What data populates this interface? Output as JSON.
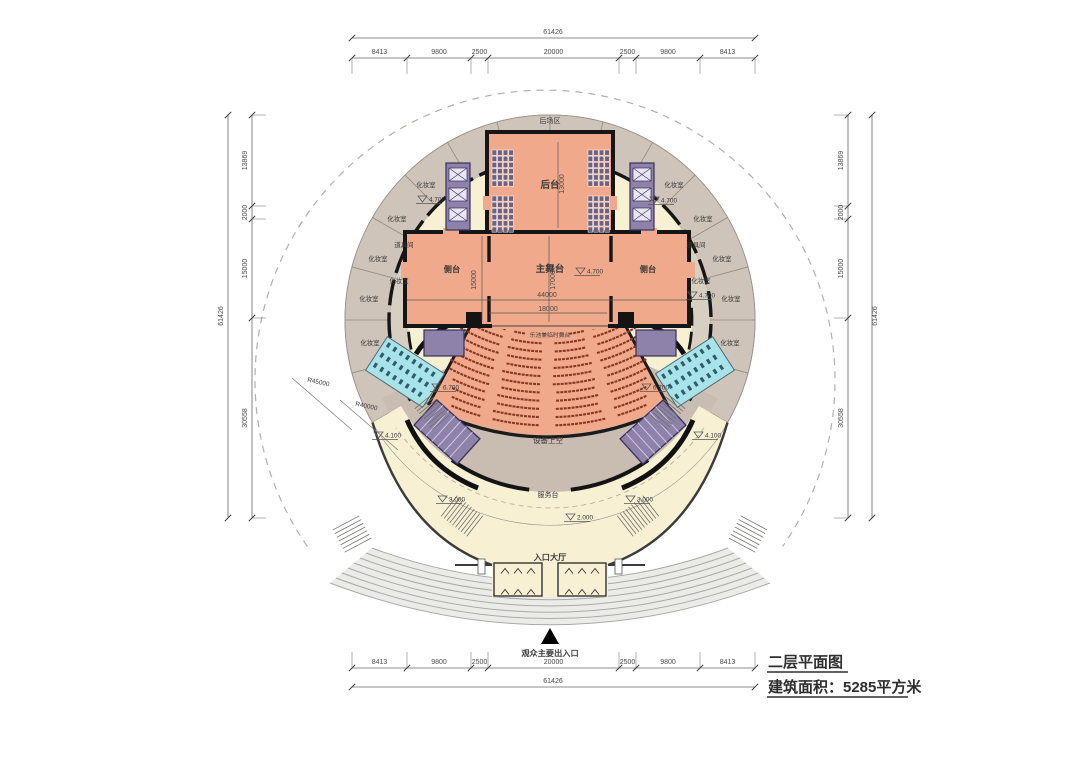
{
  "title_block": {
    "plan_title": "二层平面图",
    "area_label": "建筑面积：5285平方米"
  },
  "dims": {
    "total": "61426",
    "h_segments": [
      "8413",
      "9800",
      "2500",
      "20000",
      "2500",
      "9800",
      "8413"
    ],
    "v_segments": [
      "13869",
      "2000",
      "15000",
      "30558"
    ]
  },
  "stage_dims": {
    "d13000": "13000",
    "d15000": "15000",
    "d17000": "17000",
    "d44000": "44000",
    "d18000": "18000"
  },
  "elevations": {
    "e47": "4.700",
    "e67": "6.700",
    "e41": "4.100",
    "e30": "3.000",
    "e20": "2.000"
  },
  "radii": {
    "r45": "R45000",
    "r40": "R40000"
  },
  "rooms": {
    "backstage_zone": "后场区",
    "rear_stage": "后台",
    "main_stage": "主舞台",
    "side_stage": "侧台",
    "dressing_room": "化妆室",
    "props_room": "道具间",
    "orchestra_pit": "乐池兼临时舞台",
    "equipment_void": "设备上空",
    "service_desk": "服务台",
    "entrance_hall": "入口大厅",
    "main_entrance": "观众主要出入口"
  },
  "colors": {
    "stage_salmon": "#f0a98b",
    "ring_taupe": "#cfc4b9",
    "walkway_taupe": "#c9bcb1",
    "cream": "#f7f0d3",
    "stair_purple": "#8e82aa",
    "restroom_cyan": "#a9e3ea",
    "seat_red": "#8a3722",
    "wall_black": "#161616",
    "steps_grey": "#ebebe8"
  }
}
